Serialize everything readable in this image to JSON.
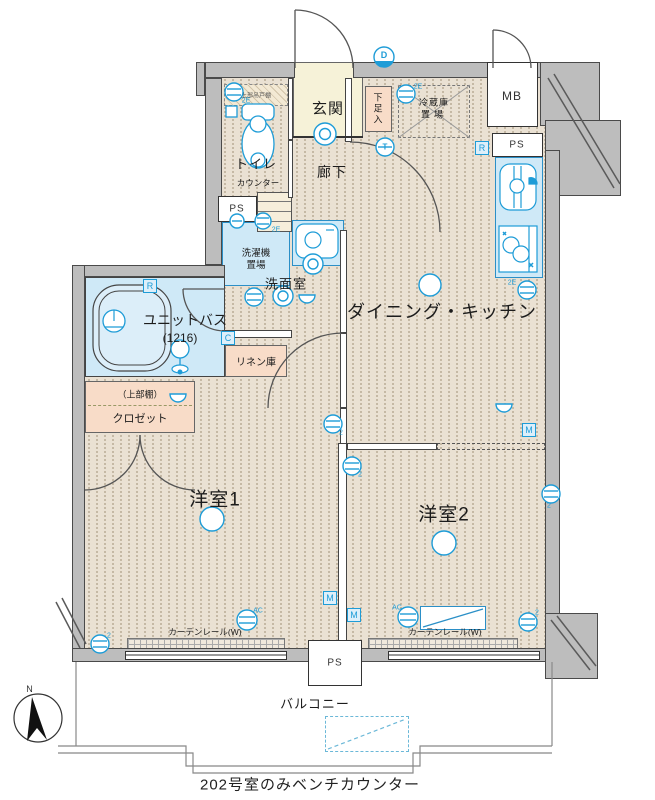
{
  "plan": {
    "caption": "202号室のみベンチカウンター",
    "compass": {
      "north_label": "N"
    },
    "rooms": {
      "genkan": "玄関",
      "shoe_box": "下足入",
      "toilet": "トイレ",
      "toilet_counter": "カウンター",
      "toilet_shelf": "上部吊戸棚",
      "corridor": "廊下",
      "washroom": "洗面室",
      "laundry_line1": "洗濯機",
      "laundry_line2": "置場",
      "fridge_line1": "冷蔵庫",
      "fridge_line2": "置場",
      "unit_bath": "ユニットバス",
      "unit_bath_size": "(1216)",
      "linen": "リネン庫",
      "closet_shelf": "（上部棚）",
      "closet": "クロゼット",
      "dining_kitchen": "ダイニング・キッチン",
      "room1": "洋室1",
      "room2": "洋室2",
      "balcony": "バルコニー",
      "curtain_rail": "カーテンレール(W)",
      "meter_box": "MB",
      "pipe_space": "PS"
    },
    "markers": {
      "doorbell": "D",
      "r_box": "R",
      "c_box": "C",
      "m_box": "M",
      "t_sym": "T",
      "outlet_2e": "2E",
      "outlet_2": "2",
      "ac": "AC"
    },
    "colors": {
      "accent_blue": "#1e9cd7",
      "floor_beige": "#eae1d3",
      "wet_blue": "#cfe9f7",
      "entry_cream": "#f6f2d8",
      "storage_pink": "#f8dcc8",
      "wall_gray": "#bdbdbd"
    }
  }
}
